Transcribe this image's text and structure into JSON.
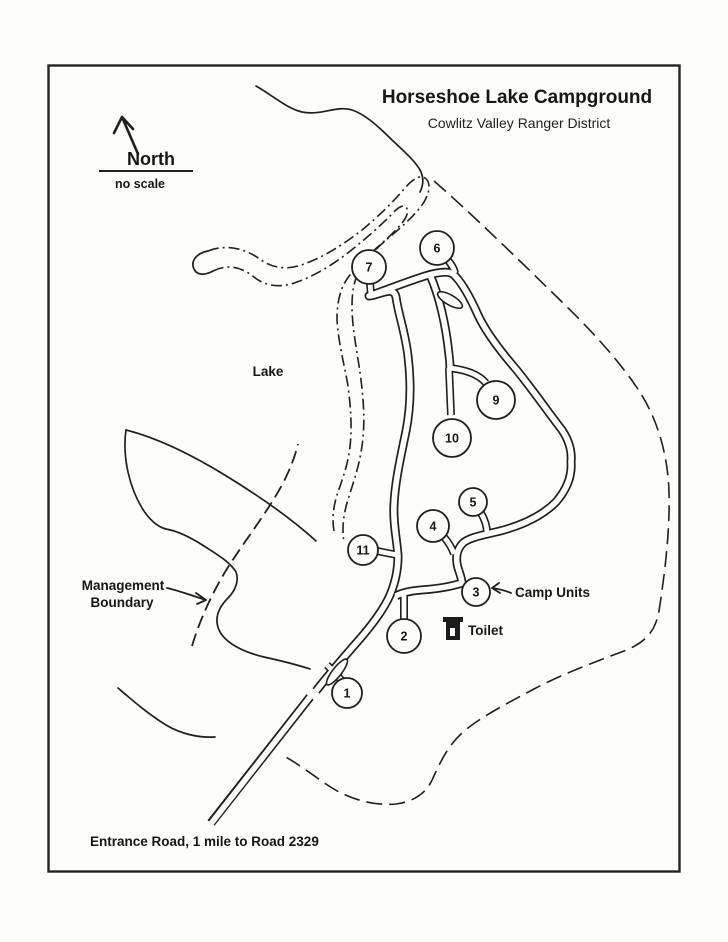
{
  "title": "Horseshoe Lake Campground",
  "subtitle": "Cowlitz Valley Ranger District",
  "compass": {
    "label": "North",
    "scale_note": "no scale"
  },
  "map_labels": {
    "lake": "Lake",
    "management_boundary_line1": "Management",
    "management_boundary_line2": "Boundary",
    "camp_units": "Camp Units",
    "toilet": "Toilet",
    "entrance_note": "Entrance Road, 1 mile to Road 2329"
  },
  "camp_sites": [
    {
      "number": "1",
      "x": 347,
      "y": 693,
      "r": 15
    },
    {
      "number": "2",
      "x": 404,
      "y": 636,
      "r": 17
    },
    {
      "number": "3",
      "x": 476,
      "y": 592,
      "r": 14
    },
    {
      "number": "4",
      "x": 433,
      "y": 526,
      "r": 16
    },
    {
      "number": "5",
      "x": 473,
      "y": 502,
      "r": 14
    },
    {
      "number": "6",
      "x": 437,
      "y": 248,
      "r": 17
    },
    {
      "number": "7",
      "x": 369,
      "y": 267,
      "r": 17
    },
    {
      "number": "9",
      "x": 496,
      "y": 400,
      "r": 19
    },
    {
      "number": "10",
      "x": 452,
      "y": 438,
      "r": 19
    },
    {
      "number": "11",
      "x": 363,
      "y": 550,
      "r": 15
    }
  ],
  "colors": {
    "ink": "#1f1f1f",
    "paper": "#fdfdfb"
  }
}
